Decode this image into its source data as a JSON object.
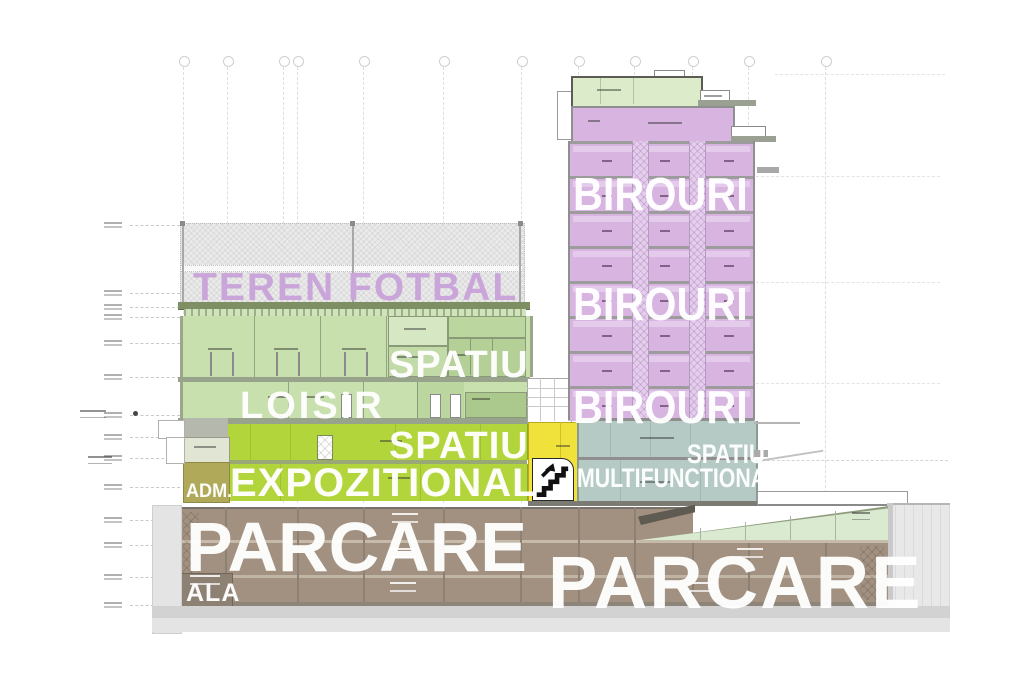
{
  "section": {
    "type": "architectural cross-section",
    "labels": {
      "roof_field": "TEREN FOTBAL",
      "offices": "BIROURI",
      "space_upper": "SPATIU",
      "leisure": "LOISIR",
      "exhibition_line1": "SPATIU",
      "exhibition_line2": "EXPOZITIONAL",
      "administration": "ADM.",
      "multifunctional_line1": "SPATIU",
      "multifunctional_line2": "MULTIFUNCTIONAL",
      "parking_left": "PARCARE",
      "parking_right": "PARCARE",
      "hall": "ALA"
    },
    "colors": {
      "label_purple": "#c9a5da",
      "office_tower_purple": "#d8b5e1",
      "leisure_green": "#c8dfae",
      "penthouse_green": "#dcecca",
      "exhibition_lime": "#b2d53c",
      "admin_olive": "#b0a95a",
      "core_yellow": "#f1e13b",
      "multifunctional_teal": "#b5cac5",
      "parking_brown": "#a29180",
      "ramp_pale_green": "#d9ead0",
      "ground_gray": "#dcdcdc",
      "label_white": "#ffffff"
    },
    "icons": {
      "stairs": "stairs-up-arrow-icon"
    }
  }
}
